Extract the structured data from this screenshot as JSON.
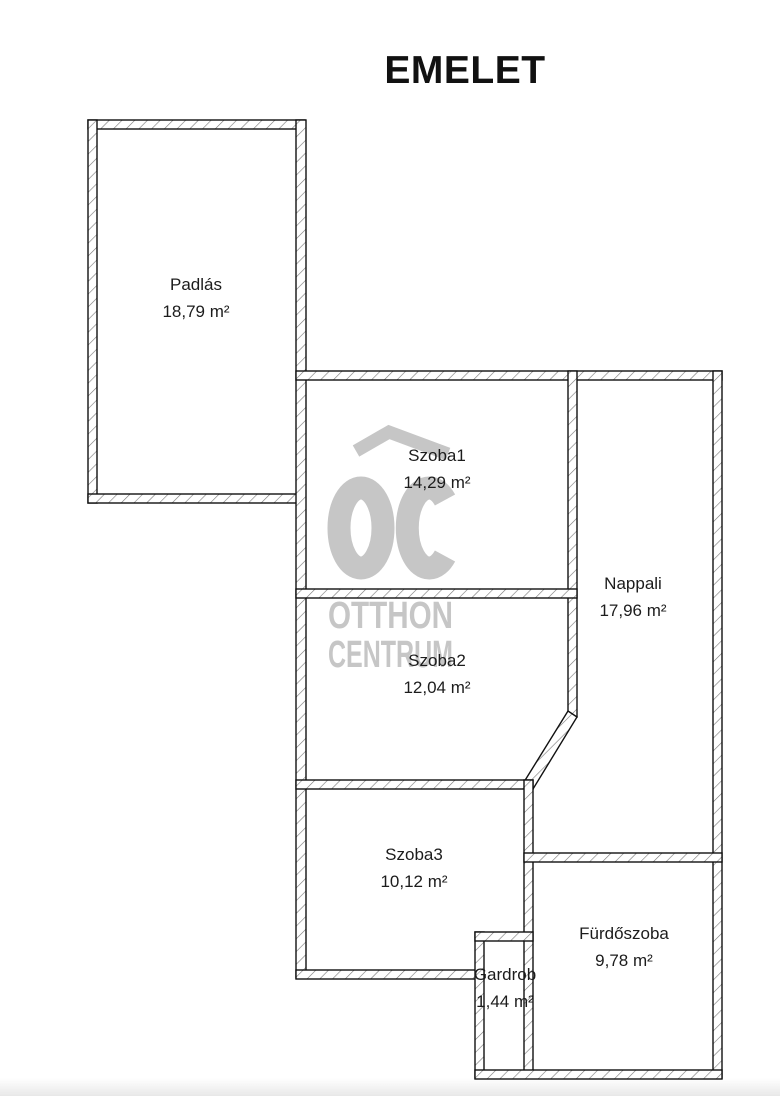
{
  "title": "EMELET",
  "rooms": [
    {
      "id": "padlas",
      "name": "Padlás",
      "area": "18,79 m²"
    },
    {
      "id": "szoba1",
      "name": "Szoba1",
      "area": "14,29 m²"
    },
    {
      "id": "szoba2",
      "name": "Szoba2",
      "area": "12,04 m²"
    },
    {
      "id": "nappali",
      "name": "Nappali",
      "area": "17,96 m²"
    },
    {
      "id": "szoba3",
      "name": "Szoba3",
      "area": "10,12 m²"
    },
    {
      "id": "furdoszoba",
      "name": "Fürdőszoba",
      "area": "9,78 m²"
    },
    {
      "id": "gardrob",
      "name": "Gardrob",
      "area": "1,44 m²"
    }
  ],
  "watermark": {
    "logo_icon": "oc-house-logo",
    "line1": "OTTHON",
    "line2": "CENTRUM",
    "color": "#c6c6c6"
  },
  "colors": {
    "wall_outline": "#111111",
    "wall_hatch": "#777777",
    "background": "#ffffff",
    "label_text": "#1c1c1c"
  }
}
